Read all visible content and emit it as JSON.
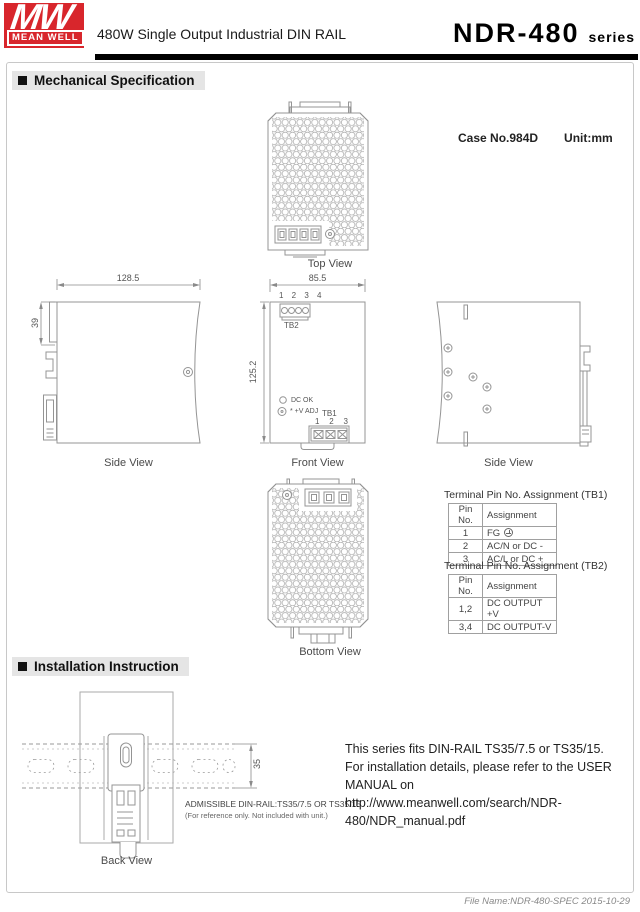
{
  "header": {
    "mw": "MW",
    "brand": "MEAN WELL",
    "subtitle": "480W Single Output Industrial DIN RAIL",
    "model": "NDR-480",
    "series": "series"
  },
  "sections": {
    "mechanical": "Mechanical Specification",
    "installation": "Installation Instruction"
  },
  "mech": {
    "case_no": "Case No.984D",
    "unit": "Unit:mm",
    "labels": {
      "top": "Top View",
      "side_left": "Side View",
      "front": "Front View",
      "side_right": "Side View",
      "bottom": "Bottom View"
    },
    "dims": {
      "w": "128.5",
      "clip": "39",
      "fw": "85.5",
      "fh": "125.2"
    },
    "front": {
      "tb2_pins": "1 2 3 4",
      "tb2": "TB2",
      "dc_ok": "DC OK",
      "v_adj": "* +V ADJ",
      "tb1": "TB1",
      "p1": "1",
      "p2": "2",
      "p3": "3"
    },
    "tables": [
      {
        "title": "Terminal Pin No.  Assignment (TB1)",
        "col1": "Pin No.",
        "col2": "Assignment",
        "rows": [
          {
            "pin": "1",
            "asg": "FG"
          },
          {
            "pin": "2",
            "asg": "AC/N or DC -"
          },
          {
            "pin": "3",
            "asg": "AC/L or DC +"
          }
        ]
      },
      {
        "title": "Terminal Pin No.  Assignment (TB2)",
        "col1": "Pin No.",
        "col2": "Assignment",
        "rows": [
          {
            "pin": "1,2",
            "asg": "DC OUTPUT +V"
          },
          {
            "pin": "3,4",
            "asg": "DC OUTPUT-V"
          }
        ]
      }
    ]
  },
  "install": {
    "back": "Back View",
    "rail_dim": "35",
    "admissible": "ADMISSIBLE DIN-RAIL:TS35/7.5 OR TS35/15",
    "ref_note": "(For reference only. Not included with unit.)",
    "lines": [
      "This series fits DIN-RAIL TS35/7.5 or TS35/15.",
      "For installation details, please refer to the USER MANUAL on",
      "http://www.meanwell.com/search/NDR-480/NDR_manual.pdf"
    ]
  },
  "footer": {
    "file": "File Name:NDR-480-SPEC  2015-10-29"
  },
  "colors": {
    "brand_red": "#d8262c",
    "line": "#949494",
    "text": "#333333"
  }
}
